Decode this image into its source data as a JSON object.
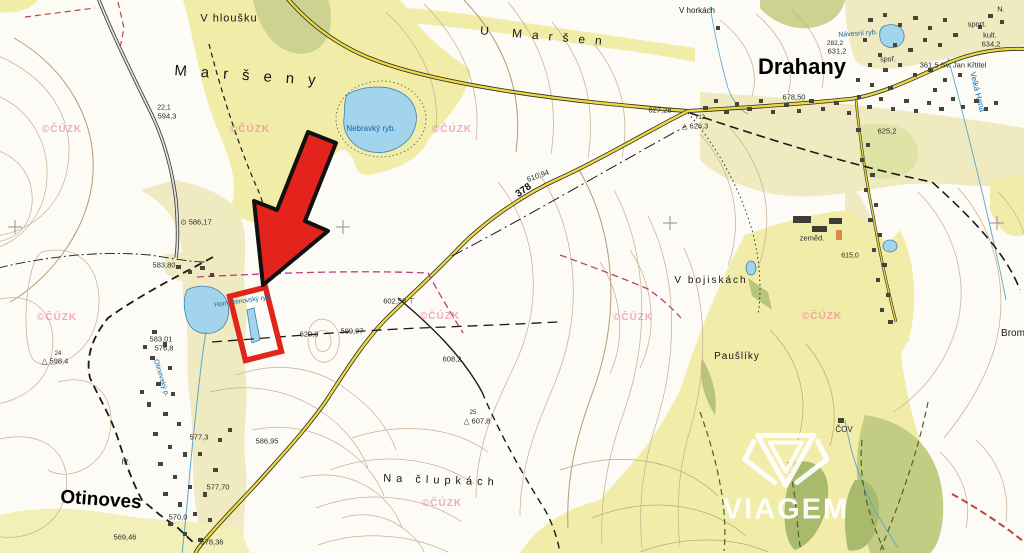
{
  "map": {
    "logo": {
      "brand": "VIAGEM"
    },
    "watermarks": {
      "text": "©ČÚZK",
      "positions": [
        [
          62,
          130
        ],
        [
          250,
          130
        ],
        [
          452,
          130
        ],
        [
          57,
          318
        ],
        [
          440,
          317
        ],
        [
          633,
          318
        ],
        [
          822,
          317
        ],
        [
          442,
          504
        ]
      ]
    },
    "labels": [
      {
        "name": "v-hlousku",
        "text": "V hloušku",
        "cls": "place",
        "x": 229,
        "y": 19,
        "fs": 11,
        "ls": 1
      },
      {
        "name": "marseny",
        "text": "Maršeny",
        "cls": "place",
        "x": 252,
        "y": 76,
        "fs": 15,
        "ls": 14,
        "rot": 4
      },
      {
        "name": "u-marsen",
        "text": "U Maršen",
        "cls": "place",
        "x": 546,
        "y": 36,
        "fs": 12,
        "ls": 10,
        "rot": 5
      },
      {
        "name": "drahany",
        "text": "Drahany",
        "cls": "place-lg",
        "x": 802,
        "y": 67,
        "fs": 22
      },
      {
        "name": "otinoves",
        "text": "Otinoves",
        "cls": "place-lg",
        "x": 101,
        "y": 500,
        "fs": 19,
        "rot": 4
      },
      {
        "name": "v-horkach",
        "text": "V horkách",
        "cls": "place",
        "x": 697,
        "y": 11,
        "fs": 8
      },
      {
        "name": "v-bojiskach",
        "text": "V bojiskách",
        "cls": "place",
        "x": 711,
        "y": 281,
        "fs": 10,
        "ls": 2
      },
      {
        "name": "pausliky",
        "text": "Paušlíky",
        "cls": "place",
        "x": 737,
        "y": 357,
        "fs": 10,
        "ls": 1
      },
      {
        "name": "na-clupkach",
        "text": "Na člupkách",
        "cls": "place",
        "x": 441,
        "y": 481,
        "fs": 11,
        "ls": 5,
        "rot": 2
      },
      {
        "name": "brom",
        "text": "Brom",
        "cls": "place",
        "x": 1013,
        "y": 334,
        "fs": 10
      },
      {
        "name": "nebravky-ryb",
        "text": "Nebravký ryb.",
        "cls": "water",
        "x": 371,
        "y": 129,
        "fs": 8
      },
      {
        "name": "navesni-ryb",
        "text": "Návesní ryb.",
        "cls": "water",
        "x": 858,
        "y": 34,
        "fs": 7,
        "rot": -4
      },
      {
        "name": "velka-hana",
        "text": "Velká Haná",
        "cls": "water",
        "x": 977,
        "y": 92,
        "fs": 8,
        "rot": 76
      },
      {
        "name": "otinovsky-p",
        "text": "Otinovský p.",
        "cls": "water",
        "x": 161,
        "y": 378,
        "fs": 7,
        "rot": 73
      },
      {
        "name": "horni-otinovsky-ryb",
        "text": "Horní otinovský ryb.",
        "cls": "water",
        "x": 243,
        "y": 302,
        "fs": 6.5,
        "rot": -8
      },
      {
        "name": "elev-22-1",
        "text": "22,1",
        "cls": "elev",
        "x": 164,
        "y": 108,
        "fs": 7
      },
      {
        "name": "elev-594-3",
        "text": "594,3",
        "cls": "elev",
        "x": 167,
        "y": 116,
        "fs": 7.5
      },
      {
        "name": "elev-586-17",
        "text": "⊙ 586,17",
        "cls": "elev",
        "x": 196,
        "y": 222,
        "fs": 7.5
      },
      {
        "name": "elev-583-80",
        "text": "583,80",
        "cls": "elev",
        "x": 164,
        "y": 265,
        "fs": 7.5
      },
      {
        "name": "elev-583-01",
        "text": "583,01",
        "cls": "elev",
        "x": 161,
        "y": 339,
        "fs": 7.5
      },
      {
        "name": "elev-576-8",
        "text": "576,8",
        "cls": "elev",
        "x": 164,
        "y": 348,
        "fs": 7.5
      },
      {
        "name": "elev-24",
        "text": "24",
        "cls": "elev",
        "x": 58,
        "y": 354,
        "fs": 6
      },
      {
        "name": "elev-598-4",
        "text": "△ 598,4",
        "cls": "elev",
        "x": 55,
        "y": 361,
        "fs": 7.5
      },
      {
        "name": "elev-627-28",
        "text": "627,28",
        "cls": "elev",
        "x": 660,
        "y": 110,
        "fs": 7.5
      },
      {
        "name": "elev-712",
        "text": "712",
        "cls": "elev",
        "x": 700,
        "y": 118,
        "fs": 6
      },
      {
        "name": "elev-626-3",
        "text": "△ 626,3",
        "cls": "elev",
        "x": 695,
        "y": 126,
        "fs": 7.5
      },
      {
        "name": "elev-610-94",
        "text": "610,94",
        "cls": "elev",
        "x": 538,
        "y": 176,
        "fs": 7.5,
        "rot": -20
      },
      {
        "name": "road-378",
        "text": "378",
        "cls": "road-num",
        "x": 524,
        "y": 191,
        "fs": 10,
        "rot": -35
      },
      {
        "name": "elev-602-58",
        "text": "602,58 ⊤",
        "cls": "elev",
        "x": 399,
        "y": 301,
        "fs": 7.5
      },
      {
        "name": "elev-620-3",
        "text": "620,3",
        "cls": "elev",
        "x": 309,
        "y": 334,
        "fs": 7.5
      },
      {
        "name": "elev-599-97",
        "text": "599,97",
        "cls": "elev",
        "x": 352,
        "y": 331,
        "fs": 7.5
      },
      {
        "name": "elev-608-2",
        "text": "608,2",
        "cls": "elev",
        "x": 452,
        "y": 359,
        "fs": 7.5
      },
      {
        "name": "elev-586-95",
        "text": "586,95",
        "cls": "elev",
        "x": 267,
        "y": 441,
        "fs": 7.5
      },
      {
        "name": "elev-577-3",
        "text": "577,3",
        "cls": "elev",
        "x": 199,
        "y": 437,
        "fs": 7.5
      },
      {
        "name": "elev-577-70",
        "text": "577,70",
        "cls": "elev",
        "x": 218,
        "y": 487,
        "fs": 7.5
      },
      {
        "name": "elev-570-0",
        "text": "570,0",
        "cls": "elev",
        "x": 178,
        "y": 517,
        "fs": 7.5
      },
      {
        "name": "elev-569-46",
        "text": "569,46",
        "cls": "elev",
        "x": 125,
        "y": 537,
        "fs": 7.5
      },
      {
        "name": "elev-578-36",
        "text": "578,36",
        "cls": "elev",
        "x": 212,
        "y": 542,
        "fs": 7.5
      },
      {
        "name": "elev-282-2",
        "text": "282,2",
        "cls": "elev",
        "x": 835,
        "y": 44,
        "fs": 6.5
      },
      {
        "name": "elev-631-2",
        "text": "631,2",
        "cls": "elev",
        "x": 837,
        "y": 51,
        "fs": 7.5
      },
      {
        "name": "elev-678-50",
        "text": "678,50",
        "cls": "elev",
        "x": 794,
        "y": 97,
        "fs": 7.5
      },
      {
        "name": "elev-625-2",
        "text": "625,2",
        "cls": "elev",
        "x": 887,
        "y": 131,
        "fs": 7.5
      },
      {
        "name": "elev-634-2",
        "text": "634,2",
        "cls": "elev",
        "x": 991,
        "y": 44,
        "fs": 7.5
      },
      {
        "name": "church-sv-jan",
        "text": "361,5 Sv. Jan Křtitel",
        "cls": "elev",
        "x": 953,
        "y": 65,
        "fs": 7.5
      },
      {
        "name": "elev-615-0",
        "text": "615,0",
        "cls": "elev",
        "x": 850,
        "y": 256,
        "fs": 7
      },
      {
        "name": "elev-25",
        "text": "25",
        "cls": "elev",
        "x": 473,
        "y": 413,
        "fs": 6
      },
      {
        "name": "elev-607-8",
        "text": "△ 607,8",
        "cls": "elev",
        "x": 477,
        "y": 421,
        "fs": 7.5
      },
      {
        "name": "hrbitov",
        "text": "hř.",
        "cls": "misc",
        "x": 126,
        "y": 462,
        "fs": 7.5
      },
      {
        "name": "sport",
        "text": "sport.",
        "cls": "misc",
        "x": 977,
        "y": 24,
        "fs": 7.5
      },
      {
        "name": "kult",
        "text": "kult.",
        "cls": "misc",
        "x": 990,
        "y": 35,
        "fs": 7.5
      },
      {
        "name": "n-abbr",
        "text": "N.",
        "cls": "misc",
        "x": 1001,
        "y": 9,
        "fs": 7.5
      },
      {
        "name": "spor",
        "text": "spoř.",
        "cls": "misc",
        "x": 888,
        "y": 60,
        "fs": 7
      },
      {
        "name": "zemed",
        "text": "zeměd.",
        "cls": "misc",
        "x": 812,
        "y": 238,
        "fs": 7.5
      },
      {
        "name": "cov",
        "text": "ČOV",
        "cls": "misc",
        "x": 844,
        "y": 430,
        "fs": 8
      }
    ]
  }
}
